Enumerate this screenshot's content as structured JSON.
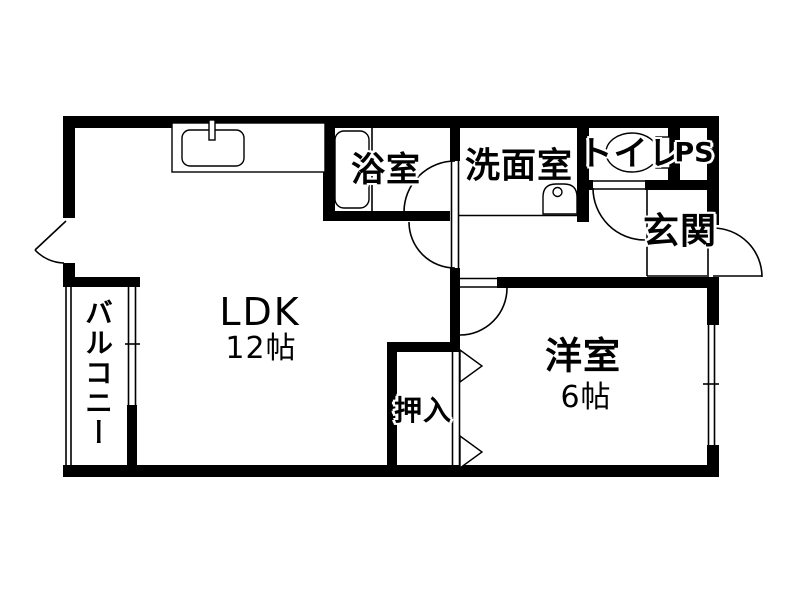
{
  "plan": {
    "rooms": {
      "ldk": {
        "label": "LDK",
        "size": "12帖"
      },
      "western": {
        "label": "洋室",
        "size": "6帖"
      },
      "bath": {
        "label": "浴室"
      },
      "washroom": {
        "label": "洗面室"
      },
      "toilet": {
        "label": "トイレ"
      },
      "ps": {
        "label": "PS"
      },
      "entrance": {
        "label": "玄関"
      },
      "closet": {
        "label": "押入"
      },
      "balcony": {
        "label": "バルコニー"
      }
    },
    "colors": {
      "wall": "#000000",
      "line": "#000000",
      "bg": "#ffffff"
    }
  }
}
